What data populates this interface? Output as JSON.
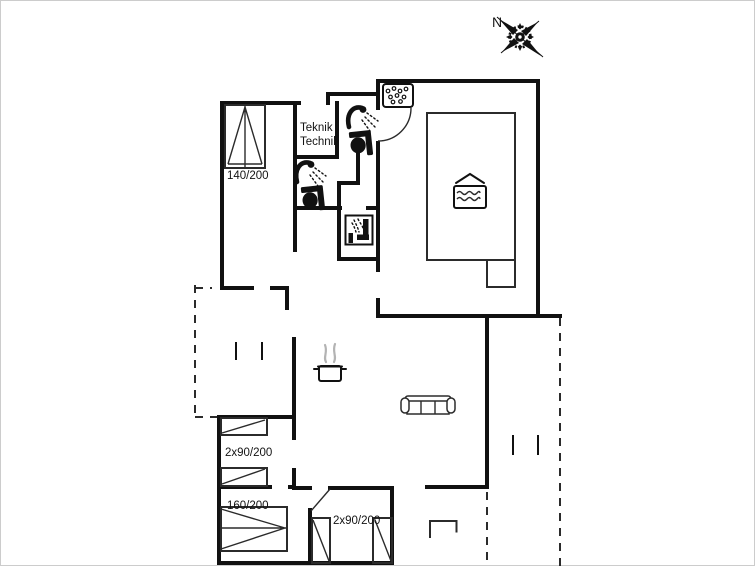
{
  "plan": {
    "title": "holiday-home-floor-plan",
    "compass": {
      "north_label": "N"
    },
    "labels": {
      "technical_room_line1": "Teknik /",
      "technical_room_line2": "Technik",
      "bed_140": "140/200",
      "bed_2x90_west": "2x90/200",
      "bed_160": "160/200",
      "bed_2x90_south": "2x90/200"
    },
    "icons": [
      "compass-rose-icon",
      "whirlpool-bath-icon",
      "shower-icon",
      "toilet-icon",
      "shower-cabin-icon",
      "indoor-pool-icon",
      "steaming-pot-icon",
      "sofa-icon",
      "terrace-table-icon"
    ],
    "colors": {
      "walls": "#111111",
      "thin_lines": "#2b2b2b",
      "steam": "#b3b3b3",
      "frame": "#cccccc",
      "background": "#ffffff"
    }
  }
}
